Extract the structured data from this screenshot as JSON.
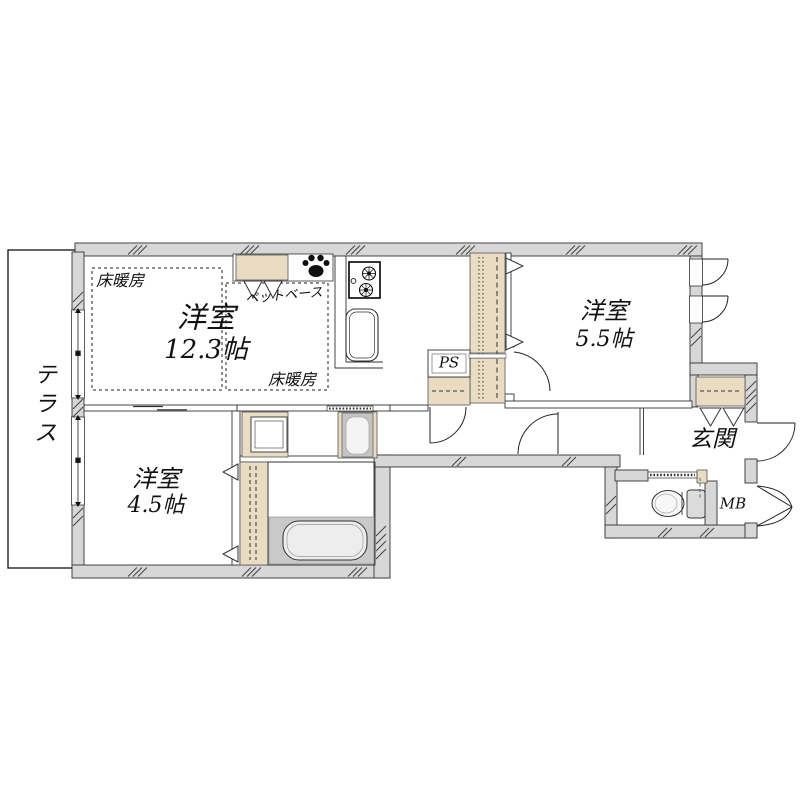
{
  "floorplan": {
    "labels": {
      "terrace": "テラス",
      "floor_heating_left": "床暖房",
      "floor_heating_right": "床暖房",
      "pet_base": "ペットベース",
      "living_room_name": "洋室",
      "living_room_size": "12.3帖",
      "bedroom_east_name": "洋室",
      "bedroom_east_size": "5.5帖",
      "bedroom_south_name": "洋室",
      "bedroom_south_size": "4.5帖",
      "pipe_space": "PS",
      "entrance": "玄関",
      "meter_box": "MB"
    },
    "colors": {
      "wall_fill": "#d7d7d7",
      "closet_fill": "#e9dcc2",
      "bath_floor_fill": "#c9c9c9",
      "appliance_fill": "#c4c4c4",
      "line": "#2a2a2a",
      "background": "#ffffff"
    }
  }
}
